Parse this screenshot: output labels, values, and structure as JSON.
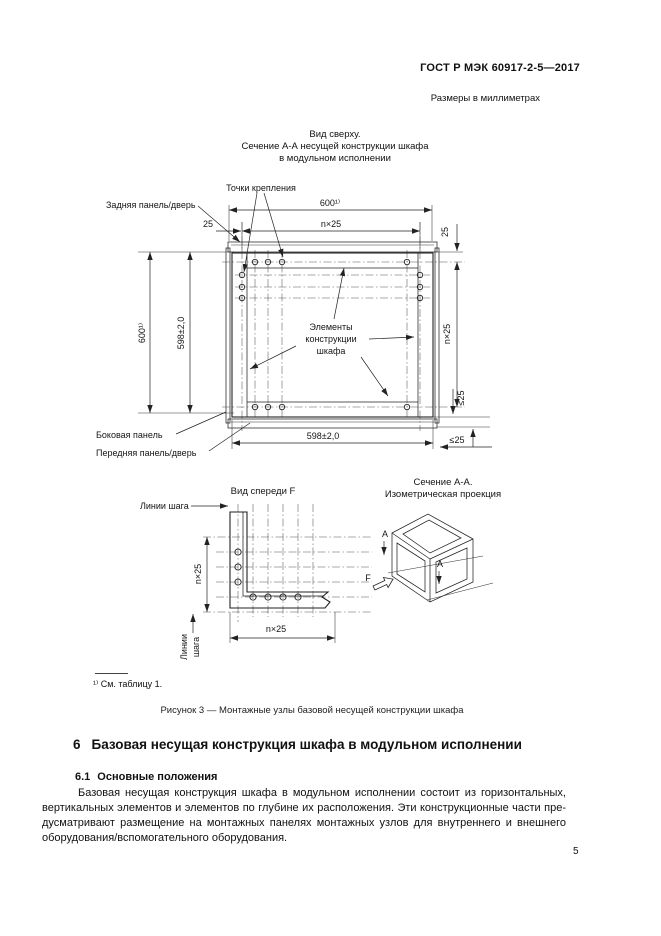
{
  "page": {
    "header": "ГОСТ Р МЭК 60917-2-5—2017",
    "units_note": "Размеры в миллиметрах",
    "page_number": "5"
  },
  "figure": {
    "view_top": {
      "title1": "Вид сверху.",
      "title2": "Сечение А-А несущей конструкции шкафа",
      "title3": "в модульном исполнении",
      "label_attachment_points": "Точки крепления",
      "label_rear_panel": "Задняя панель/дверь",
      "label_side_panel": "Боковая панель",
      "label_front_panel": "Передняя панель/дверь",
      "label_elements1": "Элементы",
      "label_elements2": "конструкции",
      "label_elements3": "шкафа",
      "dim_width_overall": "600¹⁾",
      "dim_height_overall": "600¹⁾",
      "dim_width_inner": "598±2,0",
      "dim_height_inner": "598±2,0",
      "dim_pitch_h": "n×25",
      "dim_pitch_v": "n×25",
      "dim_offset_left": "25",
      "dim_offset_right": "25",
      "dim_max_right": "≤25",
      "dim_max_bottom": "≤25"
    },
    "view_front": {
      "title": "Вид спереди F",
      "label_pitch_lines": "Линии шага",
      "label_pitch_lines_v1": "Линии",
      "label_pitch_lines_v2": "шага",
      "dim_pitch_v": "n×25",
      "dim_pitch_h": "n×25"
    },
    "view_iso": {
      "title1": "Сечение А-А.",
      "title2": "Изометрическая проекция",
      "label_a": "А",
      "label_f": "F"
    },
    "footnote": "¹⁾ См. таблицу 1.",
    "caption": "Рисунок 3 — Монтажные узлы базовой несущей конструкции шкафа"
  },
  "section": {
    "number": "6",
    "title": "Базовая несущая конструкция шкафа в модульном исполнении",
    "sub_number": "6.1",
    "sub_title": "Основные положения",
    "paragraph": "Базовая несущая конструкция шкафа в модульном исполнении состоит из горизонтальных, вер­тикальных элементов и элементов по глубине их расположения. Эти конструкционные части пре­дусматривают размещение на монтажных панелях монтажных узлов для внутреннего и внешнего оборудования/вспомогательного оборудования."
  }
}
